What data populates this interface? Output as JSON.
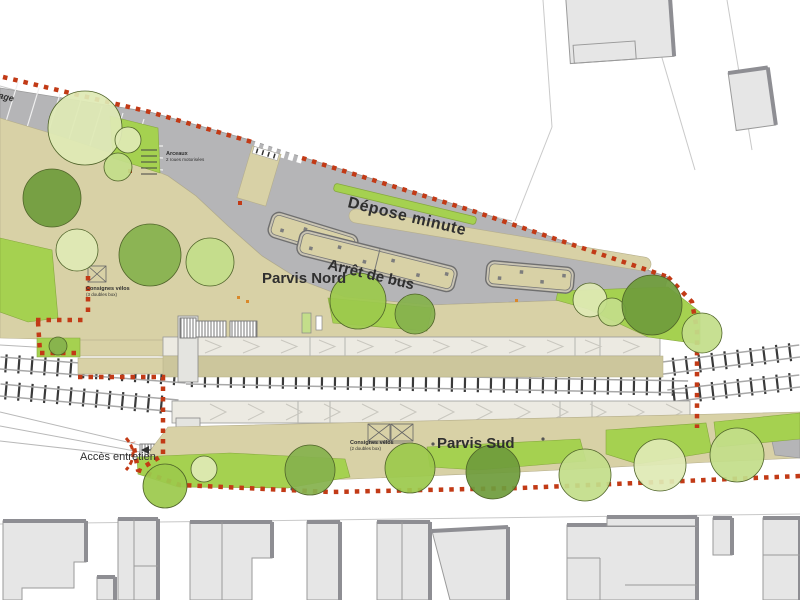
{
  "title": "Plan d'aménagement de la gare — parvis et quais",
  "labels": {
    "garage_partial": "age",
    "arceaux_line1": "Arceaux",
    "arceaux_line2": "2 roues motorisées",
    "depose_minute": "Dépose minute",
    "parvis_nord": "Parvis Nord",
    "arret_de_bus": "Arrêt de bus",
    "consignes_nord_line1": "Consignes vélos",
    "consignes_nord_line2": "(3 doubles box)",
    "consignes_sud_line1": "Consignes vélos",
    "consignes_sud_line2": "(2 doubles box)",
    "parvis_sud": "Parvis Sud",
    "acces_entretien": "Accès entretien"
  },
  "colors": {
    "boundary": "#c23a16",
    "parvis": "#d8d1a6",
    "road": "#b5b5b7",
    "platform": "#eceae2",
    "olive": "#ccc69c",
    "bldg": "#e6e6e6",
    "bldgshadow": "#8e8e93",
    "green_bright": "#a5d150",
    "green_mid": "#9cc94c",
    "green_light": "#c3de8a",
    "green_pale": "#dfeab5",
    "green_dark": "#6f9c3c",
    "green_olive": "#85b14e",
    "rail": "#a8a8a8",
    "tie": "#3a3a3a",
    "text": "#2f2f2f",
    "accent_orange": "#d9882a"
  }
}
